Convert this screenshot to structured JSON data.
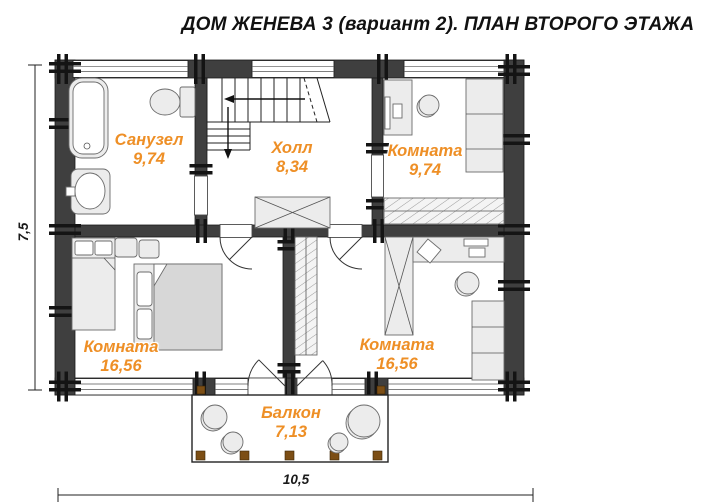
{
  "title": "ДОМ ЖЕНЕВА 3 (вариант 2). ПЛАН ВТОРОГО ЭТАЖА",
  "rooms": {
    "bathroom": {
      "name": "Санузел",
      "area": "9,74"
    },
    "hall": {
      "name": "Холл",
      "area": "8,34"
    },
    "room_top_right": {
      "name": "Комната",
      "area": "9,74"
    },
    "room_bottom_left": {
      "name": "Комната",
      "area": "16,56"
    },
    "room_bottom_right": {
      "name": "Комната",
      "area": "16,56"
    },
    "balcony": {
      "name": "Балкон",
      "area": "7,13"
    }
  },
  "dimensions": {
    "total_width_m": "10,5",
    "total_depth_m": "7,5"
  },
  "colors": {
    "room_label_orange": "#EE8F26",
    "wall_dark": "#3F3F3F",
    "furniture_gray": "#ECECEC",
    "railing_post_brown": "#7C4E15",
    "background": "#FFFFFF"
  }
}
